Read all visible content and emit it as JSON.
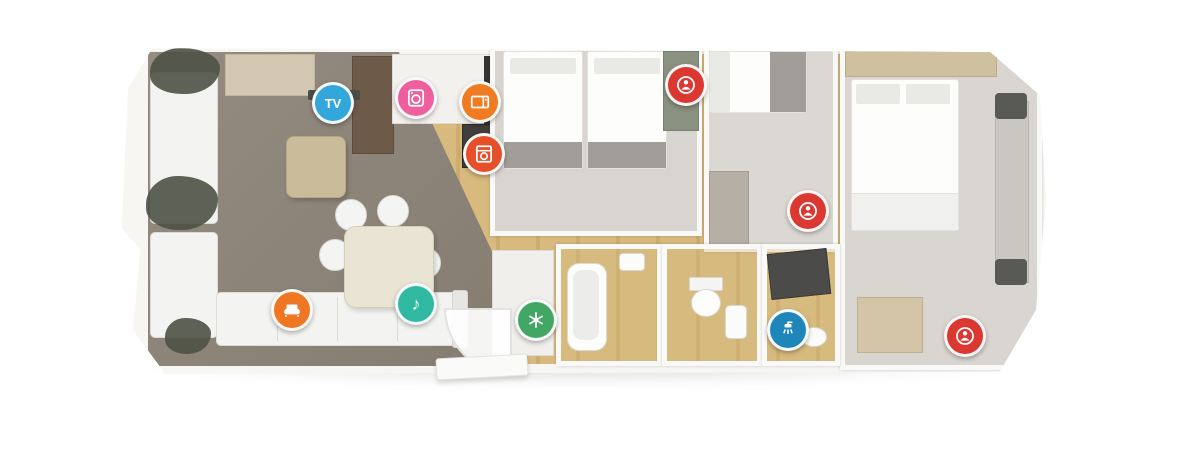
{
  "scene": {
    "kind": "static-caravan-floor-plan",
    "description": "3D top-down architectural render of a holiday home floor plan on a white background",
    "rooms_visible": [
      "lounge",
      "kitchen",
      "twin-bedroom",
      "single-bedroom",
      "master-bedroom",
      "bathroom",
      "wc",
      "shower-room"
    ]
  },
  "palette": {
    "background": "#ffffff",
    "walls": "#f7f6f3",
    "lounge_carpet": "#8e8478",
    "wood_floor": "#d8ba7f",
    "bedroom_carpet": "#d8d5d0",
    "tv_blue": "#33a7db",
    "washer_pink": "#ef5f9e",
    "microwave_orange": "#f07b22",
    "oven_red": "#e64f2a",
    "bed_marker_red": "#dc3832",
    "sofa_bed_orange": "#ef7622",
    "music_teal": "#2eb9a0",
    "fridge_green": "#44a664",
    "shower_blue": "#1f86ba"
  },
  "icons": {
    "tv": {
      "name": "tv-icon",
      "label": "TV",
      "color": "#33a7db"
    },
    "washing_machine": {
      "name": "washing-machine-icon",
      "color": "#ef5f9e"
    },
    "microwave": {
      "name": "microwave-icon",
      "color": "#f07b22"
    },
    "oven": {
      "name": "oven-icon",
      "color": "#e64f2a"
    },
    "bed_twin": {
      "name": "bed-space-icon",
      "color": "#dc3832"
    },
    "bed_single": {
      "name": "bed-space-icon",
      "color": "#dc3832"
    },
    "bed_master": {
      "name": "bed-space-icon",
      "color": "#dc3832"
    },
    "sofa_bed": {
      "name": "sofa-bed-icon",
      "color": "#ef7622"
    },
    "music": {
      "name": "music-system-icon",
      "glyph": "♪",
      "color": "#2eb9a0"
    },
    "fridge_freezer": {
      "name": "fridge-freezer-icon",
      "color": "#44a664"
    },
    "shower": {
      "name": "shower-icon",
      "color": "#1f86ba"
    }
  }
}
